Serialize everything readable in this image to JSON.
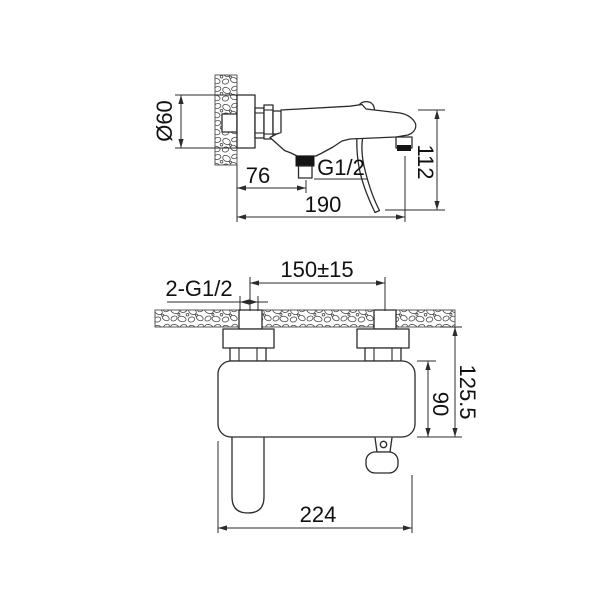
{
  "document": {
    "type": "technical-drawing",
    "background": "#ffffff",
    "line_color": "#2b2b2b",
    "views": [
      "side-section-view",
      "plan-view"
    ]
  },
  "top_view": {
    "name": "wall-mounted-spout-side-view",
    "dim_escutcheon_diameter": "Ø60",
    "dim_wall_to_outlet": "76",
    "dim_outlet_thread": "G1/2",
    "dim_spout_projection": "190",
    "dim_overall_height": "112"
  },
  "bottom_view": {
    "name": "mixer-plan-view",
    "dim_inlet_threads": "2-G1/2",
    "dim_inlet_centers": "150±15",
    "dim_body_depth": "90",
    "dim_total_depth": "125.5",
    "dim_overall_width": "224"
  }
}
